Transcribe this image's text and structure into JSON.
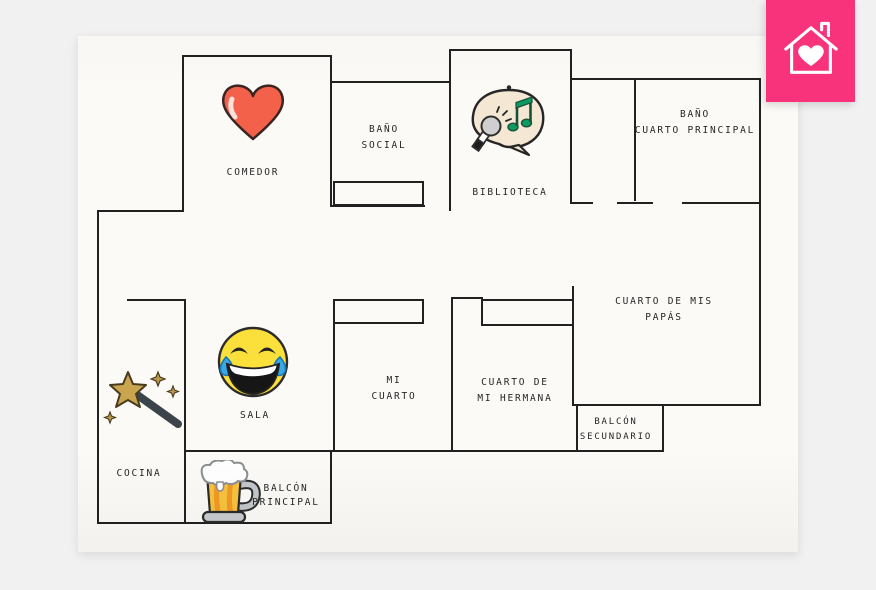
{
  "page": {
    "background_color": "#f1f1f2",
    "paper_color": "#fbfaf7",
    "wall_color": "#212121",
    "text_color": "#262626"
  },
  "badge": {
    "icon": "house-heart-icon",
    "color": "#f9337b"
  },
  "rooms": [
    {
      "name": "comedor",
      "label_lines": [
        "COMEDOR",
        ""
      ],
      "icon": "heart-icon"
    },
    {
      "name": "bano-social",
      "label_lines": [
        "BAÑO",
        "SOCIAL"
      ],
      "icon": null
    },
    {
      "name": "biblioteca",
      "label_lines": [
        "BIBLIOTECA",
        ""
      ],
      "icon": "karaoke-icon"
    },
    {
      "name": "bano-cuarto-principal",
      "label_lines": [
        "BAÑO",
        "CUARTO PRINCIPAL"
      ],
      "icon": null
    },
    {
      "name": "cuarto-de-mis-papas",
      "label_lines": [
        "CUARTO DE MIS",
        "PAPÁS"
      ],
      "icon": null
    },
    {
      "name": "mi-cuarto",
      "label_lines": [
        "MI",
        "CUARTO"
      ],
      "icon": null
    },
    {
      "name": "cuarto-de-mi-hermana",
      "label_lines": [
        "CUARTO DE",
        "MI HERMANA"
      ],
      "icon": null
    },
    {
      "name": "sala",
      "label_lines": [
        "SALA",
        ""
      ],
      "icon": "laughing-emoji-icon"
    },
    {
      "name": "cocina",
      "label_lines": [
        "COCINA",
        ""
      ],
      "icon": "magic-wand-icon"
    },
    {
      "name": "balcon-principal",
      "label_lines": [
        "BALCÓN",
        "PRINCIPAL"
      ],
      "icon": "beer-mug-icon"
    },
    {
      "name": "balcon-secundario",
      "label_lines": [
        "BALCÓN",
        "SECUNDARIO"
      ],
      "icon": null
    }
  ],
  "icon_colors": {
    "heart_red": "#f3614b",
    "emoji_yellow": "#fbdf3b",
    "tear_blue": "#37a9e8",
    "note_green": "#0a9a62",
    "bubble_cream": "#f4e8d4",
    "star_gold": "#c8a54e",
    "beer_gold": "#f8c23d",
    "foam_white": "#ffffff"
  }
}
